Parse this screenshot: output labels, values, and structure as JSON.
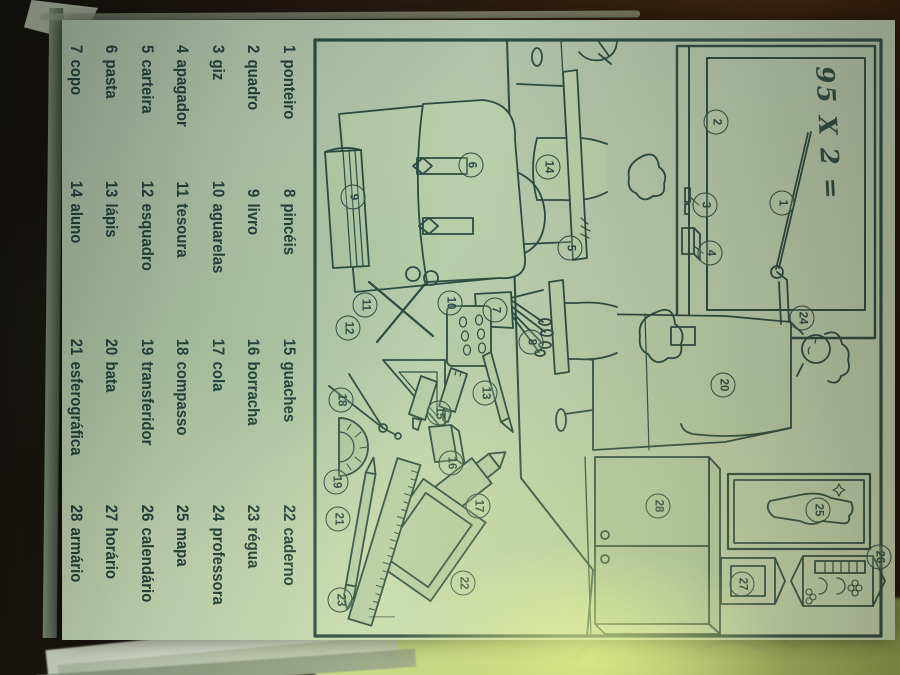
{
  "word_list": {
    "items": [
      {
        "n": "1",
        "label": "ponteiro"
      },
      {
        "n": "2",
        "label": "quadro"
      },
      {
        "n": "3",
        "label": "giz"
      },
      {
        "n": "4",
        "label": "apagador"
      },
      {
        "n": "5",
        "label": "carteira"
      },
      {
        "n": "6",
        "label": "pasta"
      },
      {
        "n": "7",
        "label": "copo"
      },
      {
        "n": "8",
        "label": "pincéis"
      },
      {
        "n": "9",
        "label": "livro"
      },
      {
        "n": "10",
        "label": "aguarelas"
      },
      {
        "n": "11",
        "label": "tesoura"
      },
      {
        "n": "12",
        "label": "esquadro"
      },
      {
        "n": "13",
        "label": "lápis"
      },
      {
        "n": "14",
        "label": "aluno"
      },
      {
        "n": "15",
        "label": "guaches"
      },
      {
        "n": "16",
        "label": "borracha"
      },
      {
        "n": "17",
        "label": "cola"
      },
      {
        "n": "18",
        "label": "compasso"
      },
      {
        "n": "19",
        "label": "transferidor"
      },
      {
        "n": "20",
        "label": "bata"
      },
      {
        "n": "21",
        "label": "esferográfica"
      },
      {
        "n": "22",
        "label": "caderno"
      },
      {
        "n": "23",
        "label": "régua"
      },
      {
        "n": "24",
        "label": "professora"
      },
      {
        "n": "25",
        "label": "mapa"
      },
      {
        "n": "26",
        "label": "calendário"
      },
      {
        "n": "27",
        "label": "horário"
      },
      {
        "n": "28",
        "label": "armário"
      }
    ]
  },
  "scene": {
    "board_equation": "95 X 2 =",
    "markers": [
      "1",
      "2",
      "3",
      "4",
      "5",
      "6",
      "7",
      "8",
      "9",
      "10",
      "11",
      "12",
      "13",
      "14",
      "15",
      "16",
      "17",
      "18",
      "19",
      "20",
      "21",
      "22",
      "23",
      "24",
      "25",
      "26",
      "27",
      "28"
    ]
  },
  "colors": {
    "ink": "#2d4c42",
    "paper": "#bdd0ae",
    "flash": "#eaf7a6",
    "background": "#2f1e0e"
  }
}
